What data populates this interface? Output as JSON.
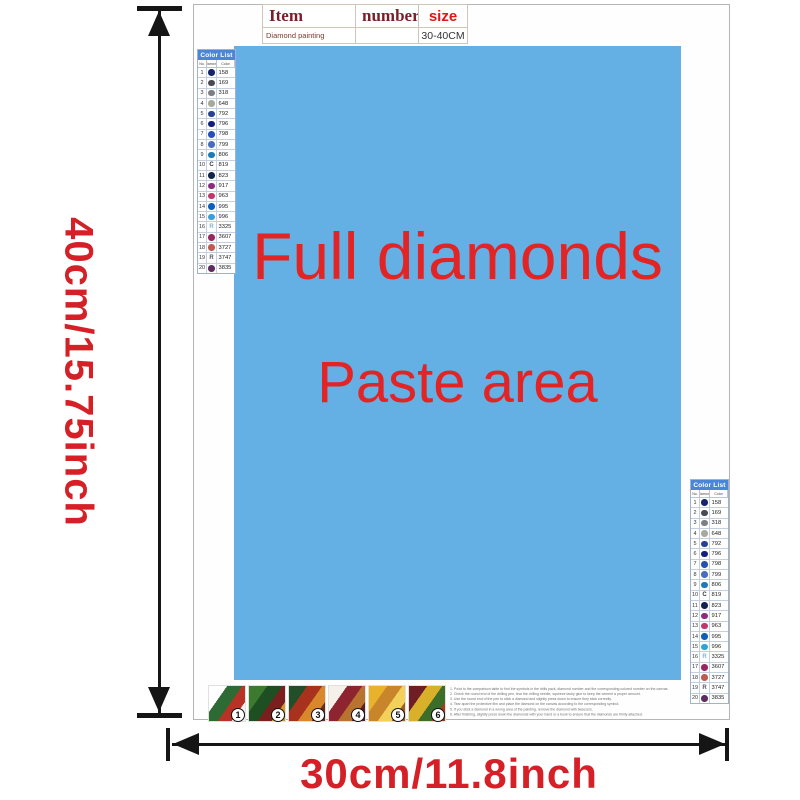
{
  "product_table": {
    "headers": {
      "item": "Item",
      "number": "number",
      "size": "size"
    },
    "row": {
      "item": "Diamond painting",
      "number": "",
      "size": "30-40CM"
    }
  },
  "canvas": {
    "line1": "Full diamonds",
    "line2": "Paste area",
    "bg_color": "#64b0e4",
    "text_color": "#e32424"
  },
  "dimensions": {
    "height_label": "40cm/15.75inch",
    "width_label": "30cm/11.8inch",
    "label_color": "#d42026",
    "arrow_color": "#151515"
  },
  "color_list": {
    "title": "Color List",
    "columns": [
      "No.",
      "Diamond",
      "Color"
    ],
    "header_bg": "#4a86d8",
    "rows": [
      {
        "no": "1",
        "code": "158",
        "symbol": "circle",
        "color": "#16246e"
      },
      {
        "no": "2",
        "code": "169",
        "symbol": "circle",
        "color": "#4a4a52"
      },
      {
        "no": "3",
        "code": "318",
        "symbol": "circle",
        "color": "#7e7e86"
      },
      {
        "no": "4",
        "code": "648",
        "symbol": "circle",
        "color": "#a8a89c"
      },
      {
        "no": "5",
        "code": "792",
        "symbol": "circle",
        "color": "#2a3f96"
      },
      {
        "no": "6",
        "code": "796",
        "symbol": "circle",
        "color": "#121f7e"
      },
      {
        "no": "7",
        "code": "798",
        "symbol": "circle",
        "color": "#2650b4"
      },
      {
        "no": "8",
        "code": "799",
        "symbol": "circle",
        "color": "#4a6cc0"
      },
      {
        "no": "9",
        "code": "806",
        "symbol": "circle",
        "color": "#1d7ab8"
      },
      {
        "no": "10",
        "code": "819",
        "symbol": "letter",
        "letter": "C",
        "color": "#333333"
      },
      {
        "no": "11",
        "code": "823",
        "symbol": "circle",
        "color": "#14224f"
      },
      {
        "no": "12",
        "code": "917",
        "symbol": "circle",
        "color": "#8e2b80"
      },
      {
        "no": "13",
        "code": "963",
        "symbol": "circle",
        "color": "#c2366e"
      },
      {
        "no": "14",
        "code": "995",
        "symbol": "circle",
        "color": "#0f5fb8"
      },
      {
        "no": "15",
        "code": "996",
        "symbol": "circle",
        "color": "#2fa3dc"
      },
      {
        "no": "16",
        "code": "3325",
        "symbol": "letter",
        "letter": "R",
        "color": "#7ab4dc"
      },
      {
        "no": "17",
        "code": "3607",
        "symbol": "circle",
        "color": "#992660"
      },
      {
        "no": "18",
        "code": "3727",
        "symbol": "circle",
        "color": "#c05a50"
      },
      {
        "no": "19",
        "code": "3747",
        "symbol": "letter",
        "letter": "R",
        "color": "#555566"
      },
      {
        "no": "20",
        "code": "3835",
        "symbol": "circle",
        "color": "#5e2d5e"
      }
    ]
  },
  "footer": {
    "steps": [
      {
        "num": "1",
        "palette": [
          "#ffffff",
          "#2e6b34",
          "#b83226",
          "#f2f2f2"
        ]
      },
      {
        "num": "2",
        "palette": [
          "#3c7a30",
          "#1e4f22",
          "#7a1e1e",
          "#d89a2a"
        ]
      },
      {
        "num": "3",
        "palette": [
          "#234f28",
          "#a8321e",
          "#d8882a",
          "#6e2a1e"
        ]
      },
      {
        "num": "4",
        "palette": [
          "#f5f0e8",
          "#8e2430",
          "#b8742e",
          "#5e1e24"
        ]
      },
      {
        "num": "5",
        "palette": [
          "#e8b32a",
          "#c8852a",
          "#f2d05a",
          "#a05e1e"
        ]
      },
      {
        "num": "6",
        "palette": [
          "#6e1e24",
          "#d8b02a",
          "#3c6e2a",
          "#a83a1e"
        ]
      }
    ],
    "instructions": [
      "1. Point to the comparison table to find the symbols in the drills pack, diamond number and the corresponding colored number on the canvas.",
      "2. Check the round end of the drilling pen, tear the drilling needle, squeeze tacky glue to keep the cement a proper amount.",
      "3. Use the round end of the pen to stick a diamond and slightly press down to ensure they stick correctly.",
      "4. Tear apart the protective film and place the diamond on the canvas according to the corresponding symbol.",
      "5. If you stick a diamond in a wrong area of the painting, remove the diamond with tweezers.",
      "6. After finishing, slightly press down the diamonds with your hand or a book to ensure that the diamonds are firmly attached."
    ]
  }
}
